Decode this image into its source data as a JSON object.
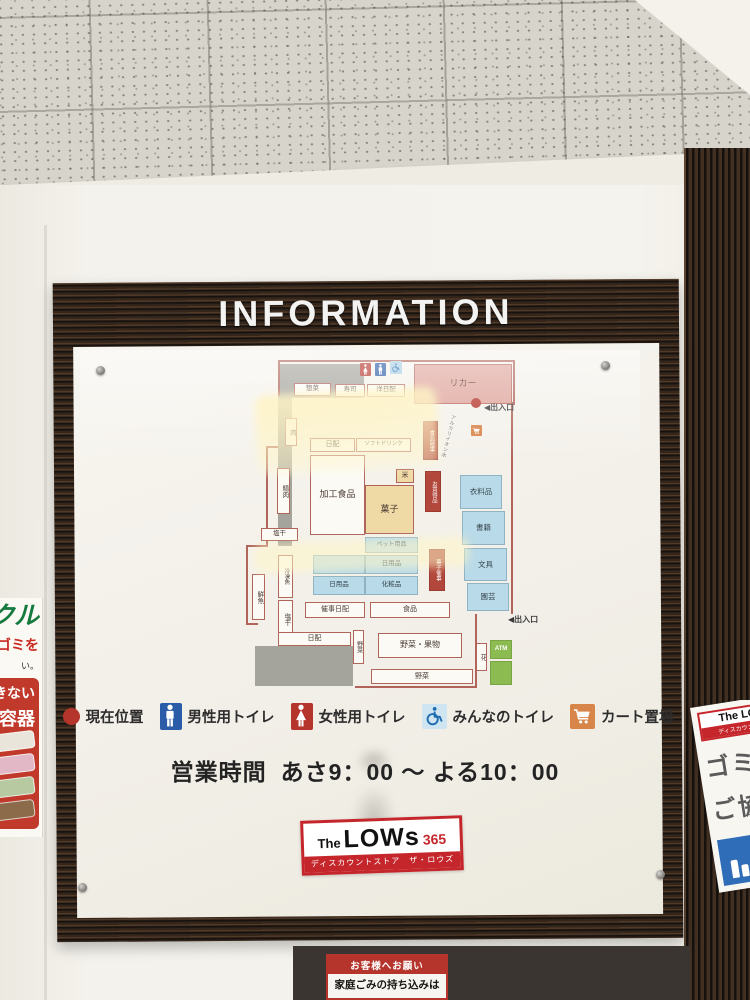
{
  "board": {
    "title": "INFORMATION",
    "hours_label": "営業時間",
    "hours_value": "あさ9：00 ～ よる10：00",
    "logo": {
      "prefix": "The",
      "name": "LOWs",
      "suffix": "365",
      "tagline": "ディスカウントストア　ザ・ロウズ"
    },
    "legend": [
      {
        "icon": "current-location-icon",
        "label": "現在位置"
      },
      {
        "icon": "male-toilet-icon",
        "label": "男性用トイレ"
      },
      {
        "icon": "female-toilet-icon",
        "label": "女性用トイレ"
      },
      {
        "icon": "accessible-toilet-icon",
        "label": "みんなのトイレ"
      },
      {
        "icon": "cart-area-icon",
        "label": "カート置場"
      }
    ]
  },
  "colors": {
    "legend_red": "#b5342c",
    "legend_blue": "#2b5ca8",
    "legend_lightblue": "#cfe6f2",
    "cart_orange": "#d8854a",
    "map_red": "#b2473c",
    "map_blue": "#b9dae8",
    "map_yellow": "#efdaa5",
    "map_pink": "#dfa59c",
    "map_green": "#8cbb52",
    "logo_red": "#c5262b"
  },
  "map": {
    "areas": [
      {
        "id": "backroom-top",
        "label": "",
        "x": 58,
        "y": 12,
        "w": 84,
        "h": 34,
        "c": "gray"
      },
      {
        "id": "backroom-left",
        "label": "",
        "x": 56,
        "y": 44,
        "w": 14,
        "h": 150,
        "c": "gray"
      },
      {
        "id": "backroom-bottom",
        "label": "",
        "x": 33,
        "y": 294,
        "w": 98,
        "h": 40,
        "c": "gray"
      },
      {
        "id": "souzai",
        "label": "惣菜",
        "x": 72,
        "y": 31,
        "w": 37,
        "h": 13,
        "c": "white",
        "fs": 6.5
      },
      {
        "id": "sushi",
        "label": "寿司",
        "x": 113,
        "y": 32,
        "w": 30,
        "h": 13,
        "c": "white",
        "fs": 6.5
      },
      {
        "id": "yo-nichihai",
        "label": "洋日配",
        "x": 145,
        "y": 32,
        "w": 38,
        "h": 13,
        "c": "white",
        "fs": 6.5
      },
      {
        "id": "liquor",
        "label": "リカー",
        "x": 192,
        "y": 12,
        "w": 98,
        "h": 40,
        "c": "pink",
        "fs": 9
      },
      {
        "id": "nichihai",
        "label": "日配",
        "x": 88,
        "y": 86,
        "w": 45,
        "h": 14,
        "c": "white",
        "fs": 7
      },
      {
        "id": "soft-drink",
        "label": "ソフトドリンク",
        "x": 134,
        "y": 86,
        "w": 55,
        "h": 14,
        "c": "white",
        "fs": 5.5
      },
      {
        "id": "niku",
        "label": "肉",
        "x": 63,
        "y": 66,
        "w": 12,
        "h": 28,
        "c": "white",
        "v": 1,
        "fs": 6.5
      },
      {
        "id": "seiniku",
        "label": "精肉",
        "x": 55,
        "y": 116,
        "w": 13,
        "h": 46,
        "c": "white",
        "v": 1,
        "fs": 6.5
      },
      {
        "id": "kako-shokuhin",
        "label": "加工食品",
        "x": 88,
        "y": 103,
        "w": 55,
        "h": 80,
        "c": "white",
        "fs": 9
      },
      {
        "id": "kome",
        "label": "米",
        "x": 174,
        "y": 117,
        "w": 18,
        "h": 14,
        "c": "yellow",
        "fs": 7
      },
      {
        "id": "kashi",
        "label": "菓子",
        "x": 143,
        "y": 133,
        "w": 49,
        "h": 49,
        "c": "yellow",
        "fs": 9
      },
      {
        "id": "shokuhin-saiji",
        "label": "食品催事",
        "x": 201,
        "y": 69,
        "w": 15,
        "h": 39,
        "c": "red",
        "v": 1,
        "fs": 5.5
      },
      {
        "id": "okaidokuhin",
        "label": "お買得品",
        "x": 203,
        "y": 119,
        "w": 16,
        "h": 41,
        "c": "red",
        "v": 1,
        "fs": 5.5
      },
      {
        "id": "kashi-saiji",
        "label": "菓子催事",
        "x": 207,
        "y": 197,
        "w": 16,
        "h": 42,
        "c": "red",
        "v": 1,
        "fs": 5.5
      },
      {
        "id": "irui",
        "label": "衣料品",
        "x": 238,
        "y": 123,
        "w": 42,
        "h": 34,
        "c": "blue",
        "fs": 7.5
      },
      {
        "id": "shoseki",
        "label": "書籍",
        "x": 240,
        "y": 159,
        "w": 43,
        "h": 34,
        "c": "blue",
        "fs": 7.5
      },
      {
        "id": "bungu",
        "label": "文具",
        "x": 242,
        "y": 196,
        "w": 43,
        "h": 33,
        "c": "blue",
        "fs": 7.5
      },
      {
        "id": "engei",
        "label": "園芸",
        "x": 245,
        "y": 231,
        "w": 42,
        "h": 28,
        "c": "blue",
        "fs": 7.5
      },
      {
        "id": "pet-yohin",
        "label": "ペット用品",
        "x": 143,
        "y": 185,
        "w": 53,
        "h": 16,
        "c": "blue",
        "fs": 6
      },
      {
        "id": "blue-blank",
        "label": "",
        "x": 91,
        "y": 203,
        "w": 52,
        "h": 19,
        "c": "blue"
      },
      {
        "id": "nichiyohin-a",
        "label": "日用品",
        "x": 143,
        "y": 203,
        "w": 53,
        "h": 19,
        "c": "blue",
        "fs": 6.5
      },
      {
        "id": "nichiyohin-b",
        "label": "日用品",
        "x": 91,
        "y": 224,
        "w": 52,
        "h": 19,
        "c": "blue",
        "fs": 6.5
      },
      {
        "id": "keshohin",
        "label": "化粧品",
        "x": 143,
        "y": 224,
        "w": 53,
        "h": 19,
        "c": "blue",
        "fs": 6.5
      },
      {
        "id": "saiji-nichihai",
        "label": "催事日配",
        "x": 83,
        "y": 250,
        "w": 60,
        "h": 16,
        "c": "white",
        "fs": 7
      },
      {
        "id": "shokuhin",
        "label": "食品",
        "x": 148,
        "y": 250,
        "w": 80,
        "h": 16,
        "c": "white",
        "fs": 7
      },
      {
        "id": "shiohoshi-a",
        "label": "塩干",
        "x": 39,
        "y": 176,
        "w": 37,
        "h": 13,
        "c": "white",
        "fs": 6.5
      },
      {
        "id": "sengyo",
        "label": "鮮魚",
        "x": 30,
        "y": 222,
        "w": 13,
        "h": 46,
        "c": "white",
        "v": 1,
        "fs": 6.5
      },
      {
        "id": "reitogyo",
        "label": "冷凍魚",
        "x": 56,
        "y": 203,
        "w": 15,
        "h": 43,
        "c": "white",
        "v": 1,
        "fs": 5.5
      },
      {
        "id": "shiohoshi-b",
        "label": "塩干",
        "x": 56,
        "y": 248,
        "w": 15,
        "h": 38,
        "c": "white",
        "v": 1,
        "fs": 6.5
      },
      {
        "id": "nichihai-b",
        "label": "日配",
        "x": 56,
        "y": 280,
        "w": 73,
        "h": 14,
        "c": "white",
        "fs": 7
      },
      {
        "id": "yasai-v",
        "label": "野菜",
        "x": 131,
        "y": 278,
        "w": 11,
        "h": 34,
        "c": "white",
        "v": 1,
        "fs": 6
      },
      {
        "id": "yasai-kudamono",
        "label": "野菜・果物",
        "x": 156,
        "y": 281,
        "w": 84,
        "h": 25,
        "c": "white",
        "fs": 8
      },
      {
        "id": "yasai-b",
        "label": "野菜",
        "x": 149,
        "y": 317,
        "w": 102,
        "h": 15,
        "c": "white",
        "fs": 7
      },
      {
        "id": "hana",
        "label": "花",
        "x": 254,
        "y": 291,
        "w": 11,
        "h": 28,
        "c": "white",
        "v": 1,
        "fs": 6.5
      },
      {
        "id": "atm",
        "label": "ATM",
        "x": 268,
        "y": 288,
        "w": 22,
        "h": 19,
        "c": "green",
        "fs": 6
      },
      {
        "id": "green-blank",
        "label": "",
        "x": 268,
        "y": 309,
        "w": 22,
        "h": 24,
        "c": "green"
      }
    ],
    "markers": [
      {
        "type": "female",
        "x": 138,
        "y": 11,
        "w": 11,
        "h": 13
      },
      {
        "type": "male",
        "x": 153,
        "y": 11,
        "w": 11,
        "h": 13
      },
      {
        "type": "accessible",
        "x": 168,
        "y": 9,
        "w": 12,
        "h": 13
      },
      {
        "type": "cart",
        "x": 249,
        "y": 73,
        "w": 11,
        "h": 11
      },
      {
        "type": "dot",
        "x": 249,
        "y": 46
      }
    ],
    "texts": [
      {
        "label": "◀出入口",
        "x": 262,
        "y": 50
      },
      {
        "label": "◀出入口",
        "x": 286,
        "y": 262
      }
    ],
    "note_text": "アルカリイオン水",
    "lines": [
      {
        "x": 130,
        "y": 8,
        "w": 163,
        "h": 2
      },
      {
        "x": 291,
        "y": 8,
        "w": 2,
        "h": 45
      },
      {
        "x": 236,
        "y": 50,
        "w": 57,
        "h": 2
      },
      {
        "x": 56,
        "y": 8,
        "w": 76,
        "h": 2
      },
      {
        "x": 56,
        "y": 8,
        "w": 2,
        "h": 38
      },
      {
        "x": 44,
        "y": 94,
        "w": 2,
        "h": 100
      },
      {
        "x": 44,
        "y": 94,
        "w": 13,
        "h": 2
      },
      {
        "x": 24,
        "y": 193,
        "w": 22,
        "h": 2
      },
      {
        "x": 24,
        "y": 193,
        "w": 2,
        "h": 80
      },
      {
        "x": 24,
        "y": 271,
        "w": 12,
        "h": 2
      },
      {
        "x": 133,
        "y": 334,
        "w": 120,
        "h": 2
      },
      {
        "x": 289,
        "y": 52,
        "w": 2,
        "h": 210
      },
      {
        "x": 253,
        "y": 262,
        "w": 2,
        "h": 74
      }
    ]
  },
  "posters": {
    "left": {
      "fragment_green": "クル",
      "fragment_red": "ゴミを",
      "fragment_small": "い。",
      "box_line1": "きない",
      "box_line2": "容器"
    },
    "right": {
      "logo_name": "The LOWs",
      "logo_sub": "ディスカウントストア",
      "line1": "ゴミの",
      "line2": "ご協力"
    },
    "bottom": {
      "title": "お客様へお願い",
      "body": "家庭ごみの持ち込みは"
    }
  }
}
